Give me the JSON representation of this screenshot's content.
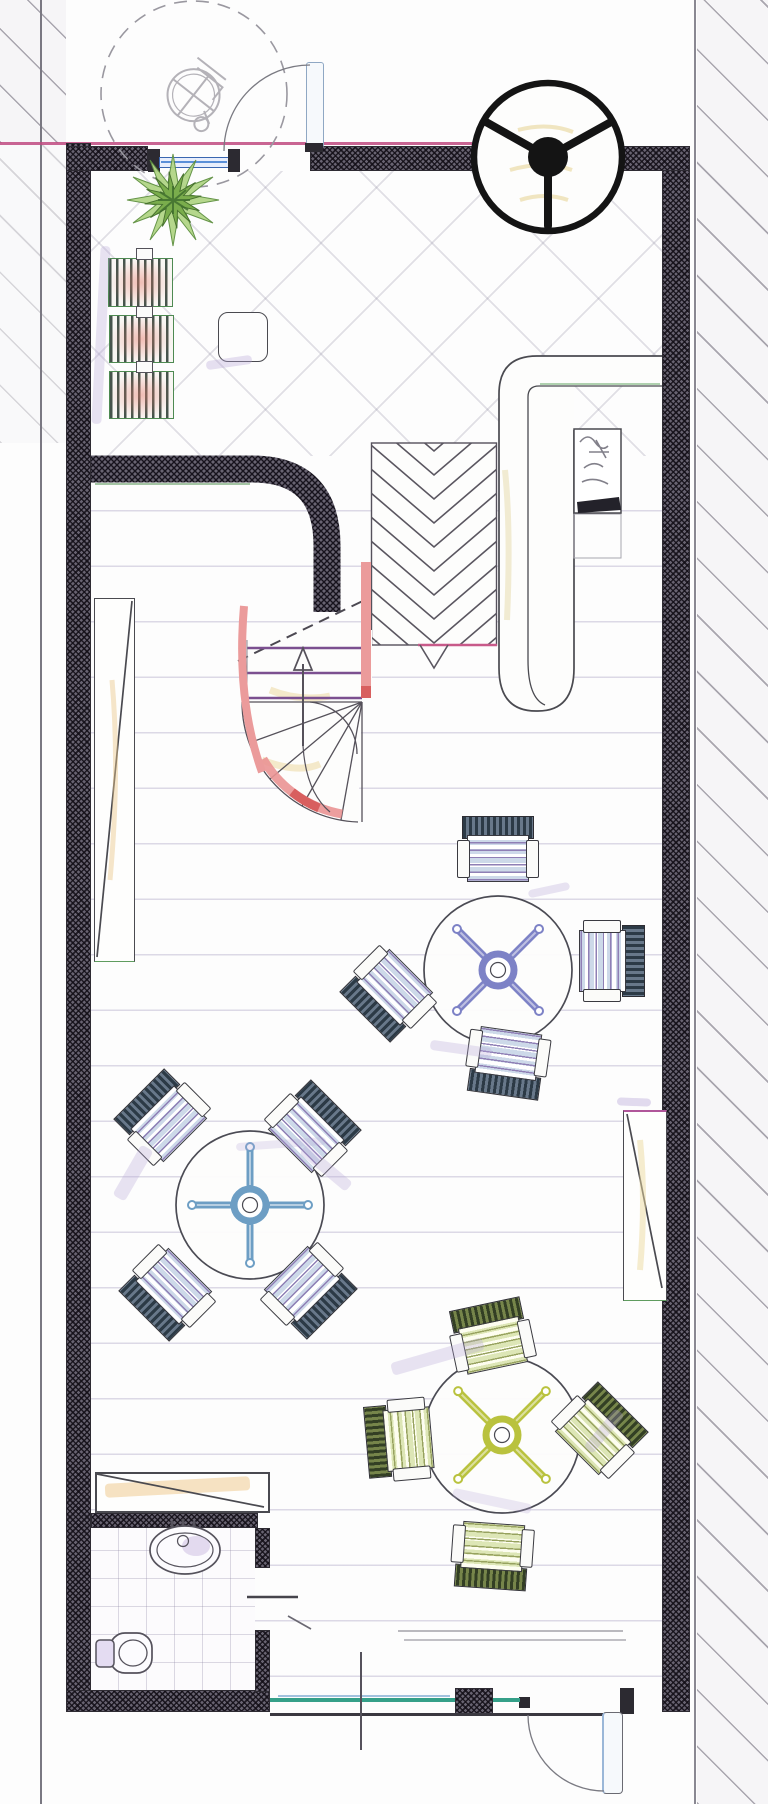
{
  "drawing": {
    "kind": "hand-rendered cafe ground-floor plan, colored pencil over ink, no text labels",
    "canvas": {
      "w": 768,
      "h": 1804
    },
    "rooms": [
      "entry-lounge",
      "main-dining-room",
      "wc"
    ],
    "wall_color": "#5a5663",
    "property_line_color": "#c04a80",
    "glazing_color": "#35a089",
    "window_color": "#3a66b0",
    "stair_color": "#eb9b9b",
    "tread_line_color": "#7c5090"
  },
  "fixtures": [
    "revolving-entrance-door",
    "side-entrance-door",
    "top-window",
    "wheelchair-turning-circle",
    "potted-plant",
    "lounge-benches",
    "lounge-side-table",
    "bar-counter",
    "espresso-machine",
    "herringbone-ramp",
    "winder-staircase",
    "wall-shelf-left",
    "wall-shelf-right",
    "wc-sink",
    "wc-toilet",
    "wc-door",
    "storefront-glazing",
    "storefront-pier",
    "rear-entrance-door",
    "section-line"
  ],
  "revolving_door": {
    "cx": 548,
    "cy": 157,
    "r": 74,
    "hub_r": 20,
    "spoke_angles_deg": [
      90,
      210,
      330
    ]
  },
  "benches": [
    {
      "x": 108,
      "y": 258,
      "w": 63,
      "h": 47
    },
    {
      "x": 109,
      "y": 315,
      "w": 63,
      "h": 46
    },
    {
      "x": 109,
      "y": 371,
      "w": 63,
      "h": 46
    }
  ],
  "bench_nubs": [
    {
      "x": 136,
      "y": 248
    },
    {
      "x": 136,
      "y": 306
    },
    {
      "x": 136,
      "y": 361
    }
  ],
  "side_table": {
    "x": 218,
    "y": 312
  },
  "chevron_ramp": {
    "x": 371,
    "y": 443,
    "w": 126,
    "h": 202,
    "row_step": 24,
    "apex_x": 434
  },
  "tables": [
    {
      "id": "table-1",
      "cx": 498,
      "cy": 970,
      "r": 74,
      "base": "x",
      "color": "#7d82c6",
      "palette": "pal-blue",
      "chairs": [
        {
          "cx": 498,
          "cy": 849,
          "rot": 0
        },
        {
          "cx": 612,
          "cy": 961,
          "rot": 90
        },
        {
          "cx": 388,
          "cy": 994,
          "rot": 225
        },
        {
          "cx": 507,
          "cy": 1063,
          "rot": 188
        }
      ]
    },
    {
      "id": "table-2",
      "cx": 250,
      "cy": 1205,
      "r": 74,
      "base": "plus",
      "color": "#6d9ec4",
      "palette": "pal-blue",
      "chairs": [
        {
          "cx": 162,
          "cy": 1117,
          "rot": 315
        },
        {
          "cx": 313,
          "cy": 1128,
          "rot": 45
        },
        {
          "cx": 167,
          "cy": 1293,
          "rot": 225
        },
        {
          "cx": 309,
          "cy": 1291,
          "rot": 135
        }
      ]
    },
    {
      "id": "table-3",
      "cx": 502,
      "cy": 1435,
      "r": 78,
      "base": "x",
      "color": "#b9c23e",
      "palette": "pal-green",
      "chairs": [
        {
          "cx": 491,
          "cy": 1336,
          "rot": 348
        },
        {
          "cx": 399,
          "cy": 1440,
          "rot": 265
        },
        {
          "cx": 600,
          "cy": 1430,
          "rot": 45
        },
        {
          "cx": 492,
          "cy": 1556,
          "rot": 184
        }
      ]
    }
  ]
}
